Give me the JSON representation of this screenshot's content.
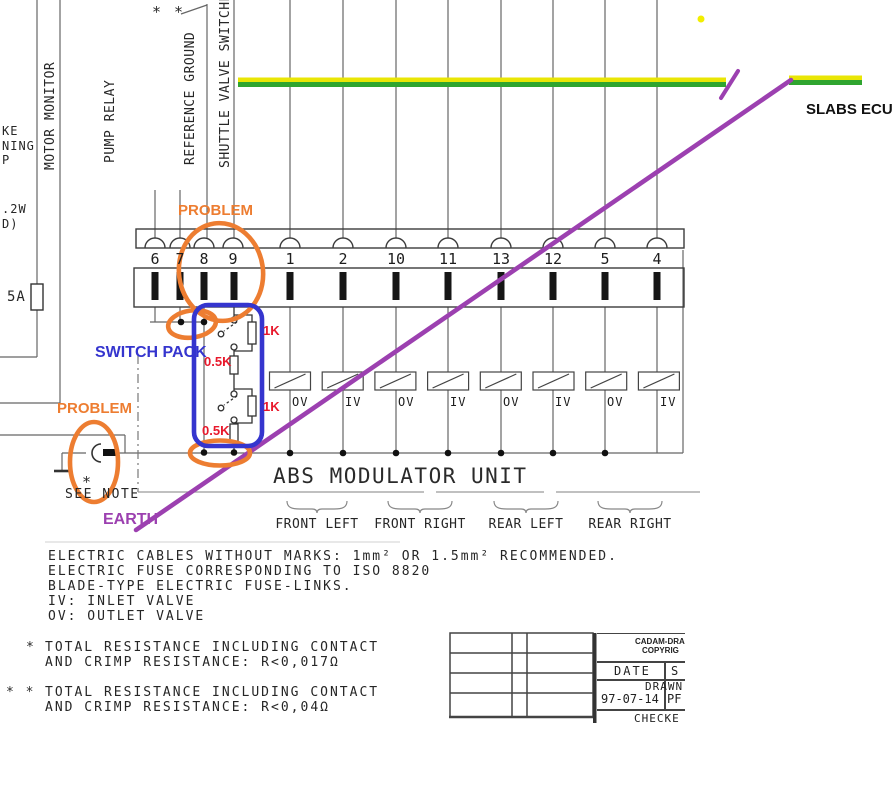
{
  "colors": {
    "annotation_orange": "#ED7D31",
    "annotation_blue": "#3535CE",
    "annotation_purple": "#9C40B0",
    "annotation_red": "#E8192C",
    "earth_wire_green": "#2FA52F",
    "earth_wire_yellow": "#E9E605",
    "diagram_line": "#444444"
  },
  "top_labels": {
    "motor_monitor": "MOTOR MONITOR",
    "pump_relay": "PUMP RELAY",
    "reference_ground": "REFERENCE GROUND",
    "shuttle_valve_switches": "SHUTTLE VALVE SWITCHES",
    "double_asterisk": "* *",
    "slabs_ecu": "SLABS ECU"
  },
  "left_fragments": {
    "f1": "KE",
    "f2": "NING",
    "f3": "P",
    "f4": ".2W",
    "f5": "D)",
    "fuse_rating": "5A"
  },
  "connector": {
    "pins": [
      "6",
      "7",
      "8",
      "9",
      "1",
      "2",
      "10",
      "11",
      "13",
      "12",
      "5",
      "4"
    ]
  },
  "valves": {
    "labels": [
      "OV",
      "IV",
      "OV",
      "IV",
      "OV",
      "IV",
      "OV",
      "IV"
    ]
  },
  "switch_pack": {
    "r1": "1K",
    "r2": "0.5K",
    "r3": "1K",
    "r4": "0.5K"
  },
  "annotations": {
    "problem_top": "PROBLEM",
    "problem_left": "PROBLEM",
    "switch_pack": "SWITCH PACK",
    "earth": "EARTH"
  },
  "modulator": {
    "title": "ABS MODULATOR UNIT",
    "channels": [
      "FRONT LEFT",
      "FRONT RIGHT",
      "REAR LEFT",
      "REAR RIGHT"
    ]
  },
  "ground": {
    "asterisk": "*",
    "see_note": "SEE NOTE"
  },
  "notes": {
    "lines": [
      "ELECTRIC CABLES WITHOUT MARKS: 1mm² OR 1.5mm² RECOMMENDED.",
      "ELECTRIC FUSE CORRESPONDING TO ISO 8820",
      "BLADE-TYPE ELECTRIC FUSE-LINKS.",
      "IV: INLET VALVE",
      "OV: OUTLET VALVE"
    ]
  },
  "star_notes": {
    "star1": "*",
    "star1_l1": "TOTAL RESISTANCE INCLUDING CONTACT",
    "star1_l2": "AND CRIMP RESISTANCE: R<0,017Ω",
    "star2": "* *",
    "star2_l1": "TOTAL RESISTANCE INCLUDING CONTACT",
    "star2_l2": "AND CRIMP RESISTANCE: R<0,04Ω"
  },
  "title_block": {
    "l1": "CADAM-DRA",
    "l2": "COPYRIG",
    "date_label": "DATE",
    "s": "S",
    "drawn_label": "DRAWN",
    "date_value": "97-07-14",
    "pf": "PF",
    "checked_label": "CHECKE"
  }
}
